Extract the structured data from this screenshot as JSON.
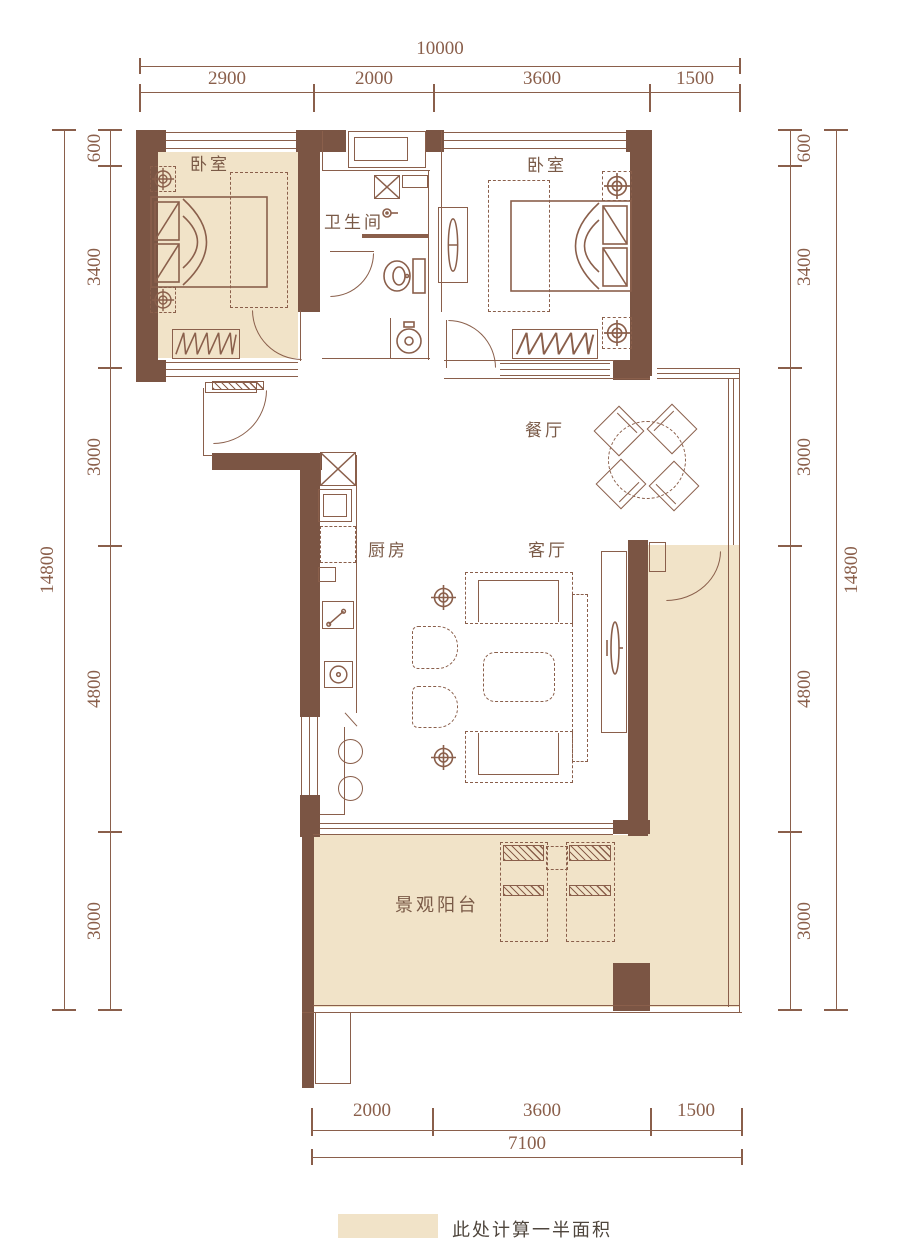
{
  "rooms": {
    "bedroom_left": "卧室",
    "bedroom_right": "卧室",
    "bathroom": "卫生间",
    "dining": "餐厅",
    "kitchen": "厨房",
    "living": "客厅",
    "balcony": "景观阳台"
  },
  "dimensions": {
    "top": {
      "total": "10000",
      "segments": [
        "2900",
        "2000",
        "3600",
        "1500"
      ]
    },
    "bottom": {
      "total": "7100",
      "segments": [
        "2000",
        "3600",
        "1500"
      ]
    },
    "left": {
      "total": "14800",
      "segments": [
        "600",
        "3400",
        "3000",
        "4800",
        "3000"
      ]
    },
    "right": {
      "total": "14800",
      "segments": [
        "600",
        "3400",
        "3000",
        "4800",
        "3000"
      ]
    }
  },
  "legend": {
    "label": "此处计算一半面积"
  },
  "colors": {
    "wall": "#7b5544",
    "half_area_floor": "#f1e3c8",
    "drawing_line": "#8a5f4b"
  }
}
